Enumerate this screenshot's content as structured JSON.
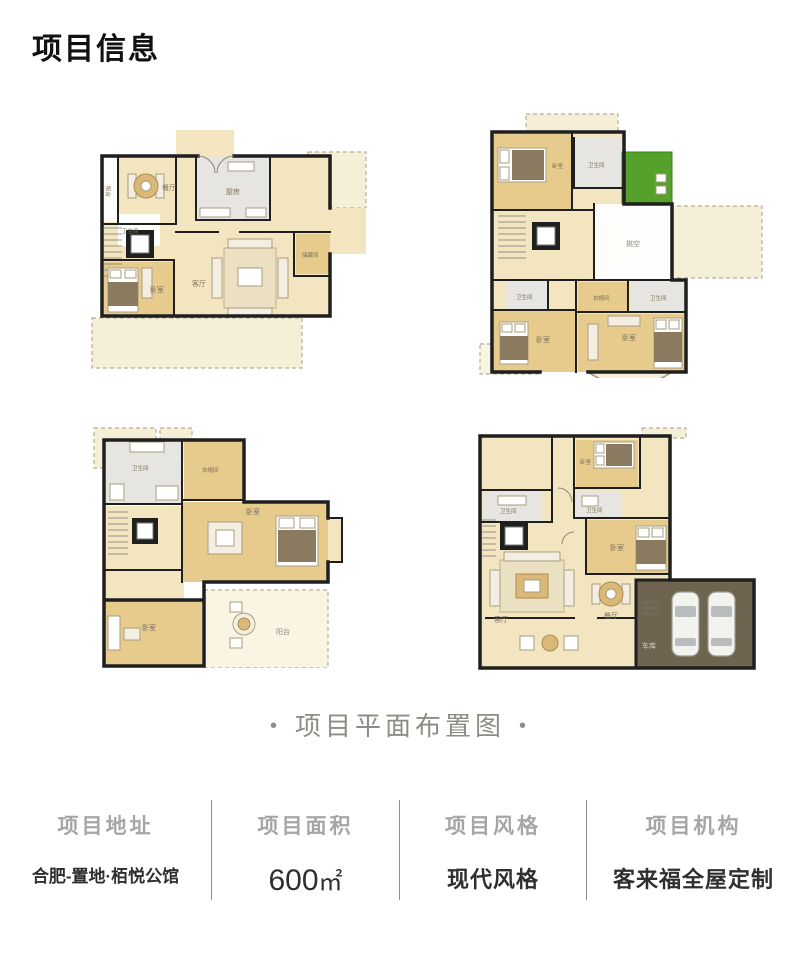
{
  "title": "项目信息",
  "caption": {
    "dot": "•",
    "text": "项目平面布置图"
  },
  "plans": [
    {
      "labels": [
        "餐厅",
        "厨房",
        "卫生间",
        "卧室",
        "客厅",
        "储藏间",
        "阳台"
      ]
    },
    {
      "labels": [
        "卧室",
        "卫生间",
        "挑空",
        "卫生间",
        "衣帽间",
        "卫生间",
        "卧室",
        "卧室"
      ]
    },
    {
      "labels": [
        "卫生间",
        "衣帽间",
        "卧室",
        "卧室",
        "阳台"
      ]
    },
    {
      "labels": [
        "卫生间",
        "卧室",
        "卫生间",
        "卧室",
        "客厅",
        "餐厅",
        "车库"
      ]
    }
  ],
  "info": [
    {
      "label": "项目地址",
      "value": "合肥-置地·栢悦公馆"
    },
    {
      "label": "项目面积",
      "value": "600",
      "unit": "㎡"
    },
    {
      "label": "项目风格",
      "value": "现代风格"
    },
    {
      "label": "项目机构",
      "value": "客来福全屋定制"
    }
  ],
  "colors": {
    "background": "#ffffff",
    "title_text": "#111111",
    "caption_gray": "#8d8d85",
    "label_gray": "#a6a6a6",
    "value_dark": "#2f2f2f",
    "wall": "#1f1f1f",
    "floor_cream": "#f2e5c0",
    "floor_wood": "#e7cb8d",
    "room_gray": "#e6e5e1",
    "terrace": "#f6efd7",
    "lawn_green": "#55a12b",
    "garage_brown": "#6f6450"
  }
}
